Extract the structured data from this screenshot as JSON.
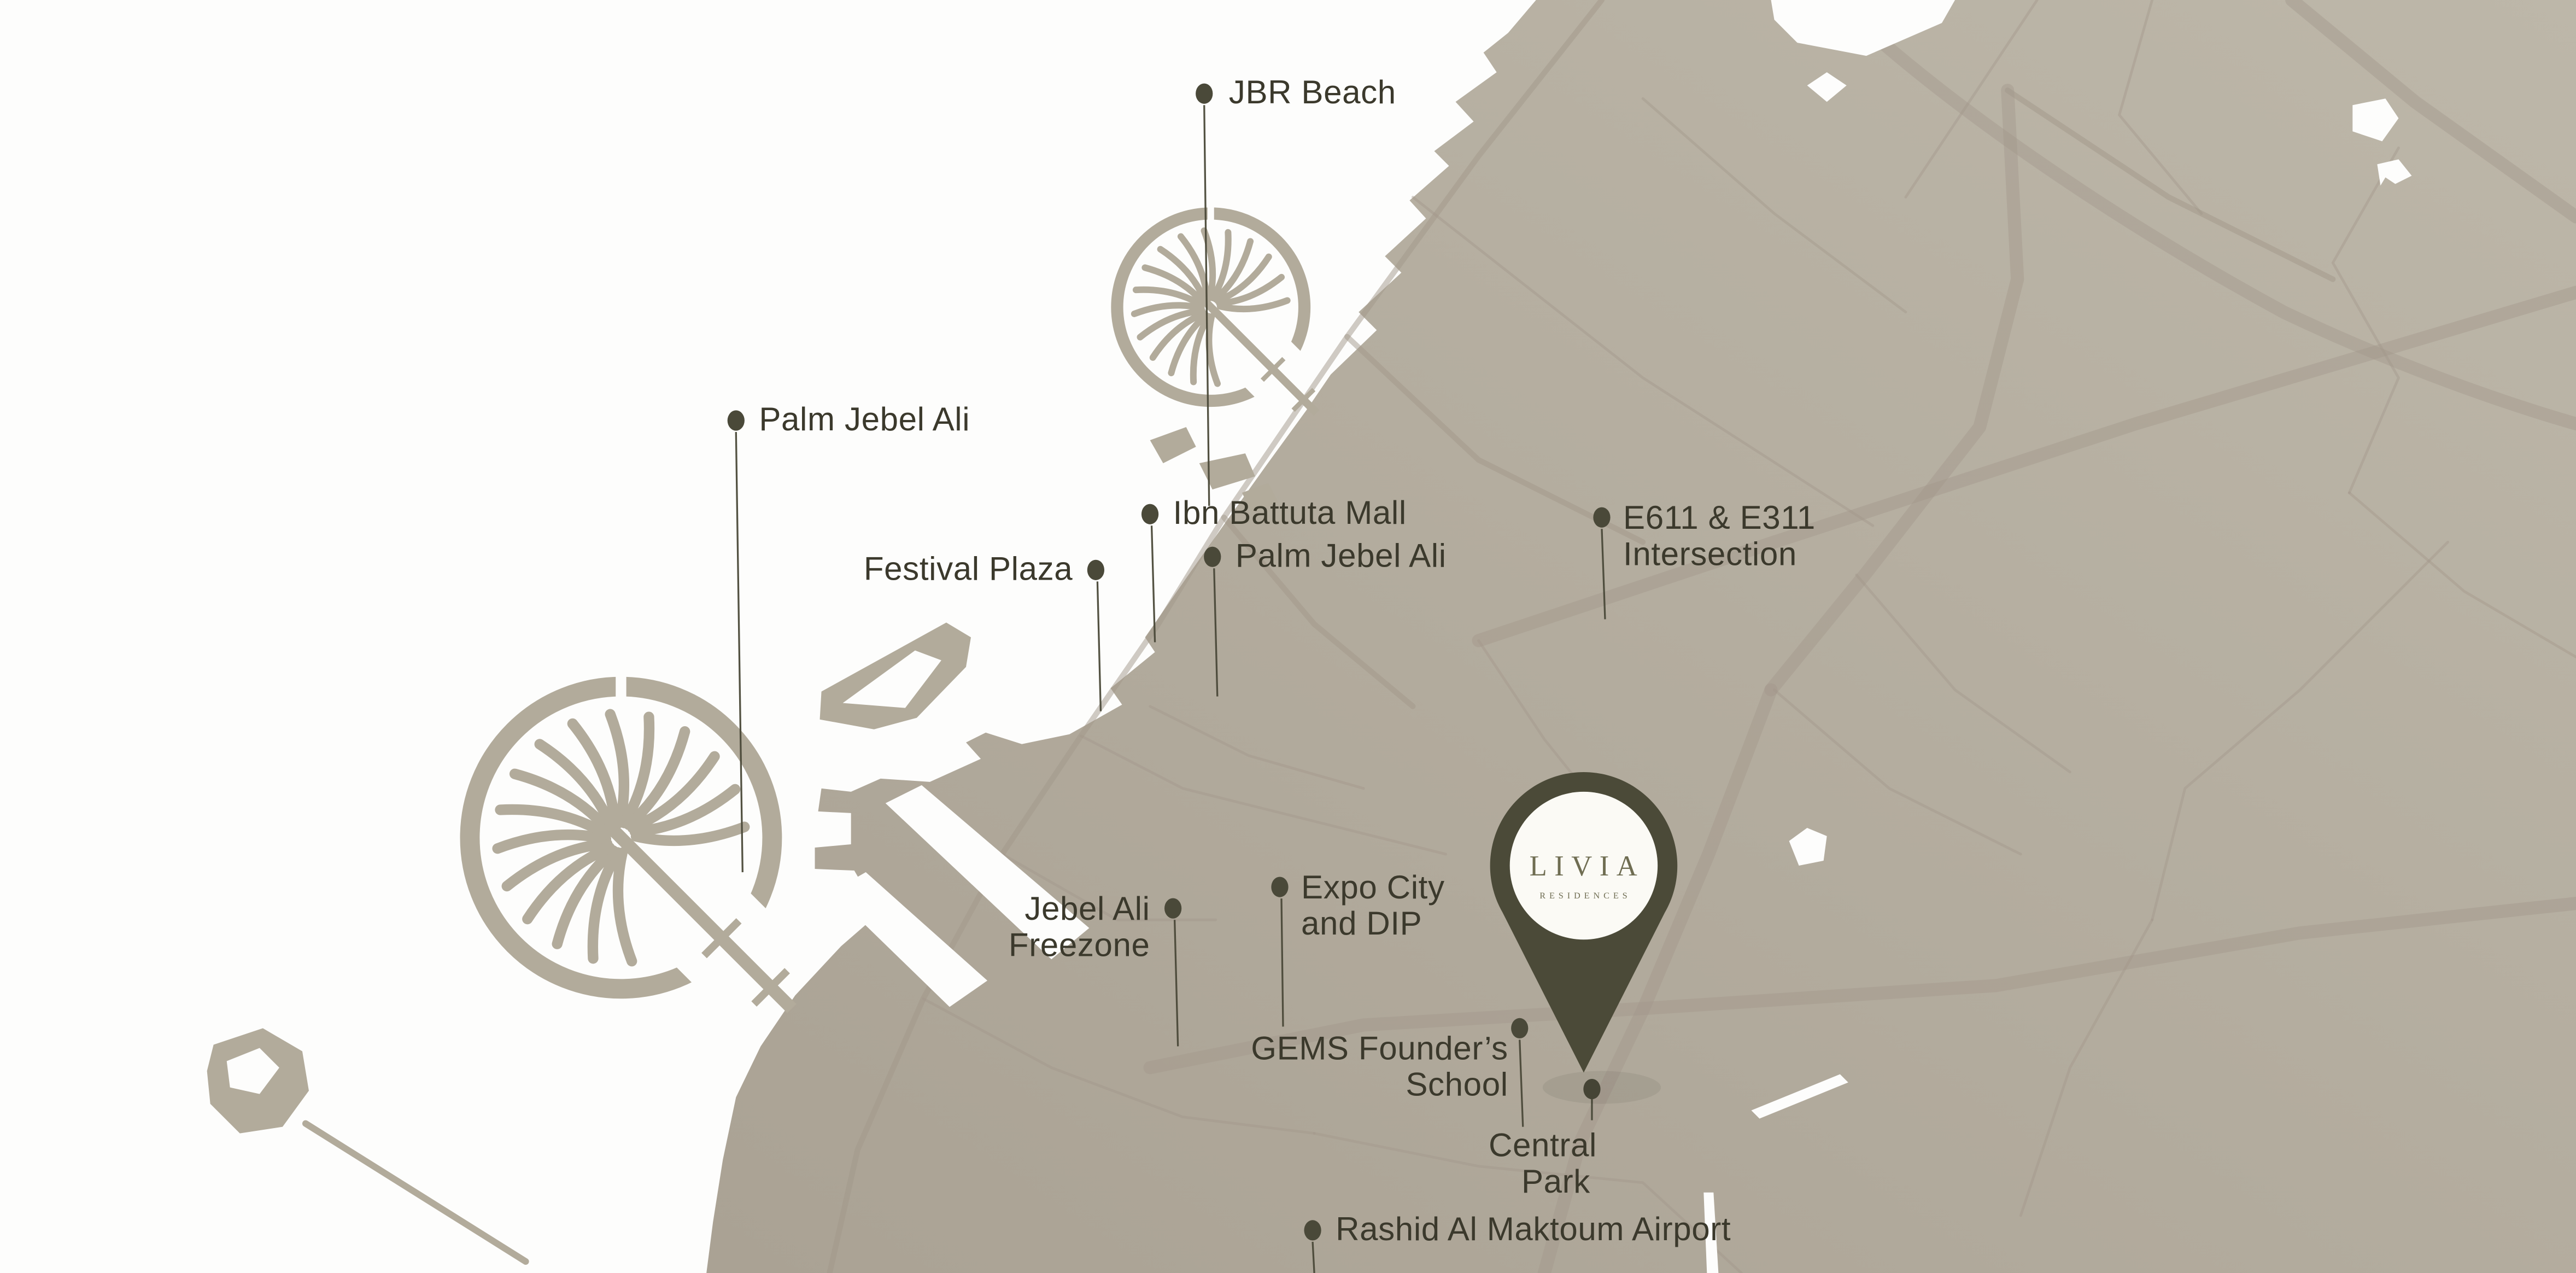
{
  "map": {
    "pin": {
      "brand": "LIVIA",
      "sub": "RESIDENCES"
    },
    "labels": [
      {
        "id": "jbr-beach",
        "lines": [
          "JBR Beach"
        ]
      },
      {
        "id": "palm-jebel-ali-west",
        "lines": [
          "Palm Jebel Ali"
        ]
      },
      {
        "id": "ibn-battuta-mall",
        "lines": [
          "Ibn Battuta Mall"
        ]
      },
      {
        "id": "palm-jebel-ali",
        "lines": [
          "Palm Jebel Ali"
        ]
      },
      {
        "id": "festival-plaza",
        "lines": [
          "Festival Plaza"
        ]
      },
      {
        "id": "e611-e311",
        "lines": [
          "E611 & E311",
          "Intersection"
        ]
      },
      {
        "id": "jebel-ali-freezone",
        "lines": [
          "Jebel Ali",
          "Freezone"
        ]
      },
      {
        "id": "expo-city-dip",
        "lines": [
          "Expo City",
          "and DIP"
        ]
      },
      {
        "id": "gems-founders-school",
        "lines": [
          "GEMS Founder’s",
          "School"
        ]
      },
      {
        "id": "central-park",
        "lines": [
          "Central",
          "Park"
        ]
      },
      {
        "id": "rashid-airport",
        "lines": [
          "Rashid Al Maktoum Airport"
        ]
      }
    ],
    "colors": {
      "water": "#fdfdfc",
      "land_light": "#bdb7a9",
      "land_dark": "#aaa294",
      "palm": "#b2ab9b",
      "road": "#a1978a",
      "ink": "#3b392c",
      "dot": "#4a4939",
      "pin": "#4b4a38",
      "pin_face": "#fbfaf5",
      "gold": "#6f6d52"
    }
  }
}
